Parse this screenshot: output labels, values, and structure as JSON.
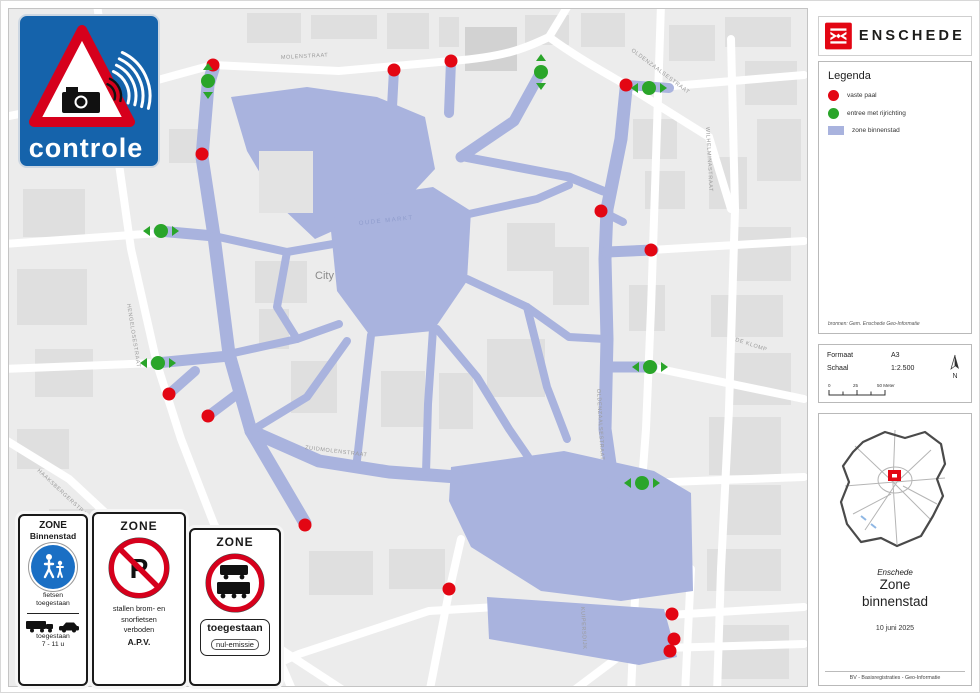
{
  "controle_sign": {
    "label": "controle"
  },
  "brand": {
    "name": "ENSCHEDE"
  },
  "legend": {
    "title": "Legenda",
    "items": [
      {
        "label": "vaste paal",
        "color": "#e30613",
        "shape": "circle"
      },
      {
        "label": "entree met rijrichting",
        "color": "#2aa52a",
        "shape": "circle"
      },
      {
        "label": "zone binnenstad",
        "color": "#a9b3de",
        "shape": "square"
      }
    ],
    "source": "bronnen: Gem. Enschede Geo-Informatie"
  },
  "format_box": {
    "format_label": "Formaat",
    "format_value": "A3",
    "scale_label": "Schaal",
    "scale_value": "1:2.500",
    "scalebar_labels": [
      "0",
      "25",
      "50 Meter"
    ],
    "north_label": "N"
  },
  "title_block": {
    "municipality": "Enschede",
    "title_line1": "Zone",
    "title_line2": "binnenstad",
    "date": "10 juni 2025",
    "credit": "BV - Basisregistraties - Geo-Informatie"
  },
  "zone_signs": {
    "pedestrian": {
      "header": "ZONE",
      "subheader": "Binnenstad",
      "allow1": "fietsen",
      "allow2": "toegestaan",
      "bottom1": "toegestaan",
      "bottom2": "7 - 11 u"
    },
    "no_parking": {
      "header": "ZONE",
      "symbol": "P",
      "line1": "stallen brom- en",
      "line2": "snorfietsen",
      "line3": "verboden",
      "line4": "A.P.V."
    },
    "trucks": {
      "header": "ZONE",
      "sub1": "toegestaan",
      "sub2": "nul-emissie"
    }
  },
  "map": {
    "city_label": "City",
    "square_label": "OUDE MARKT",
    "colors": {
      "zone": "#a9b3de",
      "red_marker": "#e30613",
      "green_marker": "#2aa52a",
      "background": "#ececec",
      "road": "#ffffff",
      "building": "#dfdfdf"
    },
    "street_labels": [
      {
        "text": "OLDENZAALSESTRAAT",
        "x": 622,
        "y": 42,
        "rot": 37
      },
      {
        "text": "OLDENZAALSESTRAAT",
        "x": 588,
        "y": 380,
        "rot": 87
      },
      {
        "text": "DEURNINGERSTRAAT",
        "x": 82,
        "y": 60,
        "rot": 80
      },
      {
        "text": "WILHELMINASTRAAT",
        "x": 697,
        "y": 118,
        "rot": 87
      },
      {
        "text": "HENGELOSESTRAAT",
        "x": 118,
        "y": 295,
        "rot": 81
      },
      {
        "text": "HAAKSBERGERSTRAAT",
        "x": 28,
        "y": 462,
        "rot": 43
      },
      {
        "text": "ZUIDMOLENSTRAAT",
        "x": 296,
        "y": 440,
        "rot": 7
      },
      {
        "text": "DE KLOMP",
        "x": 726,
        "y": 332,
        "rot": 18
      },
      {
        "text": "KUIPERSDIJK",
        "x": 572,
        "y": 598,
        "rot": 87
      },
      {
        "text": "MOLENSTRAAT",
        "x": 272,
        "y": 50,
        "rot": -3
      }
    ],
    "markers": {
      "red": [
        [
          204,
          56
        ],
        [
          193,
          145
        ],
        [
          385,
          61
        ],
        [
          442,
          52
        ],
        [
          617,
          76
        ],
        [
          592,
          202
        ],
        [
          642,
          241
        ],
        [
          160,
          385
        ],
        [
          199,
          407
        ],
        [
          296,
          516
        ],
        [
          440,
          580
        ],
        [
          663,
          605
        ],
        [
          665,
          630
        ],
        [
          661,
          642
        ]
      ],
      "green": [
        {
          "x": 199,
          "y": 72,
          "dir": "v"
        },
        {
          "x": 532,
          "y": 63,
          "dir": "v"
        },
        {
          "x": 640,
          "y": 79,
          "dir": "h"
        },
        {
          "x": 152,
          "y": 222,
          "dir": "h"
        },
        {
          "x": 149,
          "y": 354,
          "dir": "h"
        },
        {
          "x": 641,
          "y": 358,
          "dir": "h"
        },
        {
          "x": 633,
          "y": 474,
          "dir": "h"
        }
      ]
    }
  }
}
